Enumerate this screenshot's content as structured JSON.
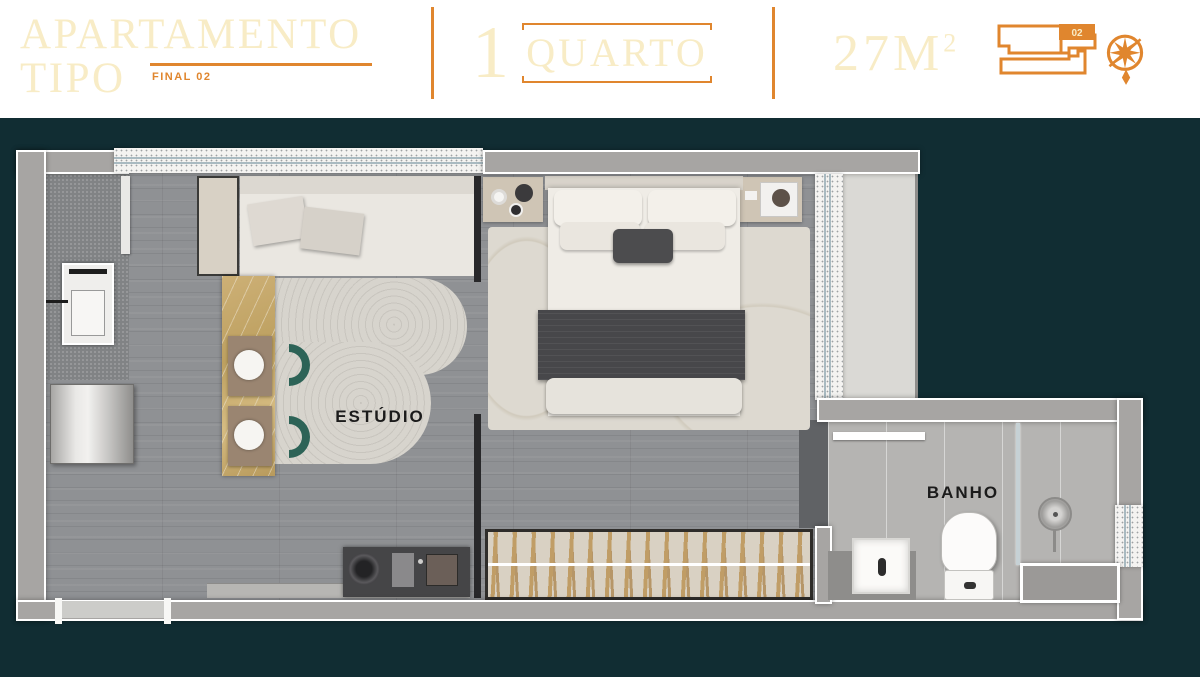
{
  "header": {
    "title_line1": "APARTAMENTO",
    "title_line2": "TIPO",
    "final_label": "FINAL 02",
    "units": {
      "count": "1",
      "label": "QUARTO"
    },
    "area": {
      "value": "27M",
      "superscript": "2"
    },
    "keyplan_unit": "02"
  },
  "plan": {
    "rooms": [
      {
        "name": "ESTÚDIO"
      },
      {
        "name": "BANHO"
      }
    ]
  },
  "icons": [
    {
      "name": "keyplan-icon",
      "meaning": "building key plan with highlighted unit 02"
    },
    {
      "name": "compass-icon",
      "meaning": "compass rose / north indicator"
    }
  ],
  "colors": {
    "background": "#112d33",
    "accent_orange": "#e0862e",
    "cream_text": "#f8ecc6",
    "wall_gray": "#a7a5a3",
    "chair_teal": "#2d6357"
  }
}
